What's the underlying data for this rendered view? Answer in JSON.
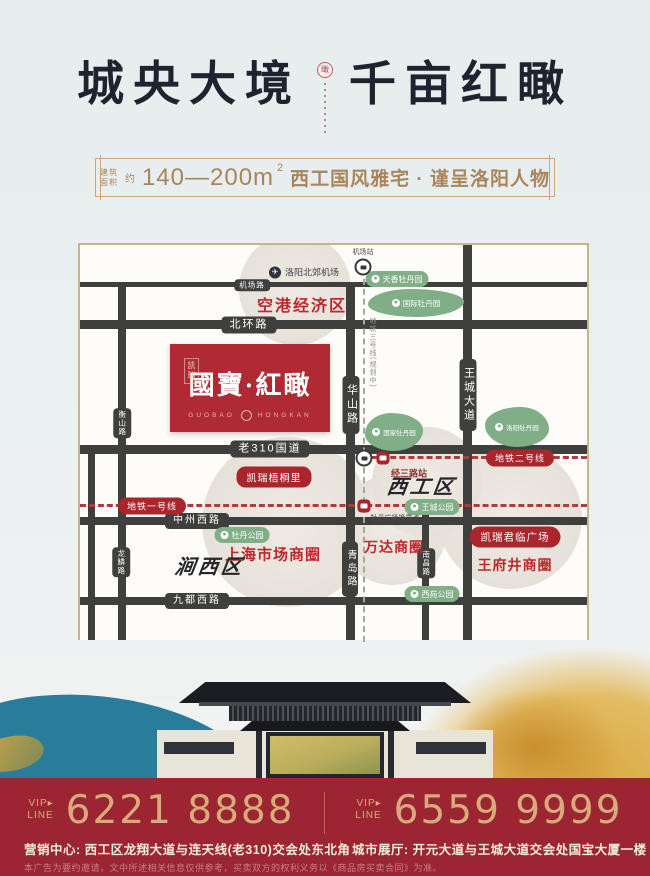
{
  "colors": {
    "accent_red": "#b02a33",
    "footer_bg": "#9b2530",
    "map_green": "#7fae87",
    "road_dark": "#3f3f3d",
    "gold_border": "#c7a87a",
    "title_ink": "#1d2430"
  },
  "header": {
    "title_left": "城央大境",
    "title_right": "千亩红瞰",
    "seal_char": "瞰",
    "subtitle": {
      "area_label_1": "建筑",
      "area_label_2": "面积",
      "approx": "约",
      "range": "140—200m",
      "sup": "2",
      "tagline": "西工国风雅宅 · 谨呈洛阳人物"
    }
  },
  "map": {
    "airport": "洛阳北郊机场",
    "airport_station": "机场站",
    "airport_zone": "空港经济区",
    "roads": {
      "jichang": "机场路",
      "beihuan": "北环路",
      "lao310": "老310国道",
      "zhongzhou_west": "中州西路",
      "jiudu_west": "九都西路",
      "hengshan": "衡山路",
      "huashan": "华山路",
      "wangcheng_ave": "王城大道",
      "qingdao": "青岛路",
      "nanchang": "南昌路",
      "longlin": "龙鳞路"
    },
    "metro": {
      "line1": "地铁一号线",
      "line2": "地铁二号线",
      "planned": "地铁三号线(规划中)",
      "jingsan_station": "经三路站",
      "mudan_transfer": "牡丹广场换乘点"
    },
    "parks": {
      "tianxiang": "天香牡丹园",
      "guoji": "国际牡丹园",
      "guojia": "国家牡丹园",
      "luoyang_mudan": "洛阳牡丹园",
      "mudan_park": "牡丹公园",
      "wangcheng_park": "王城公园",
      "xiyuan_park": "西苑公园"
    },
    "districts": {
      "jianxi": "涧西区",
      "xigong": "西工区"
    },
    "landmarks": {
      "wutongli": "凯瑞梧桐里",
      "junlin_plaza": "凯瑞君临广场",
      "shanghai_circle": "上海市场商圈",
      "wanda_circle": "万达商圈",
      "wangfujing_circle": "王府井商圈"
    },
    "logo": {
      "brand": "凯瑞",
      "name": "國寶·紅瞰",
      "latin_left": "GUOBAO",
      "latin_right": "HONGKAN"
    }
  },
  "footer": {
    "vip_top": "VIP▸",
    "vip_bottom": "LINE",
    "phone_left": "6221 8888",
    "phone_right": "6559 9999",
    "address_left": "营销中心: 西工区龙翔大道与连天线(老310)交会处东北角",
    "address_right": "城市展厅: 开元大道与王城大道交会处国宝大厦一楼",
    "disclaimer": "本广告为要约邀请，文中所述相关信息仅供参考，买卖双方的权利义务以《商品房买卖合同》为准。"
  }
}
